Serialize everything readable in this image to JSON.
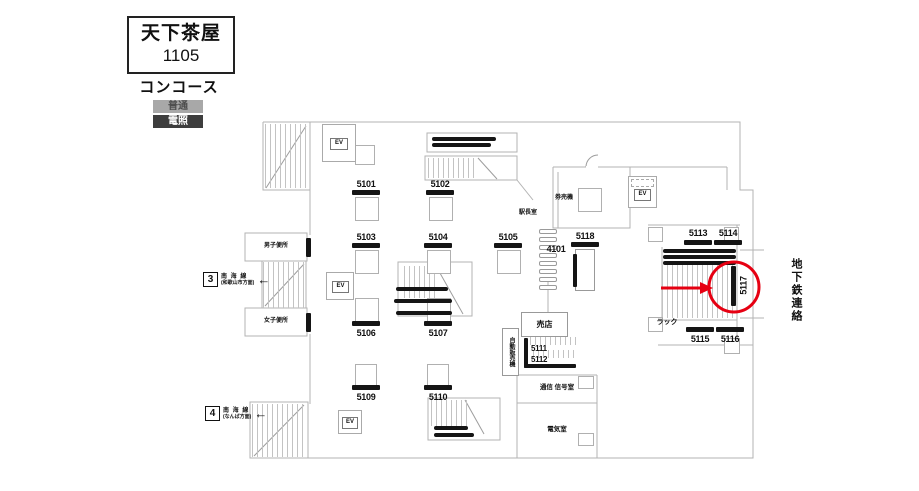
{
  "header": {
    "station": "天下茶屋",
    "code": "1105",
    "area": "コンコース"
  },
  "legend": {
    "normal": "普通",
    "illuminated": "電照"
  },
  "positions": {
    "5101": "5101",
    "5102": "5102",
    "5103": "5103",
    "5104": "5104",
    "5105": "5105",
    "5106": "5106",
    "5107": "5107",
    "5109": "5109",
    "5110": "5110",
    "5111": "5111",
    "5112": "5112",
    "5113": "5113",
    "5114": "5114",
    "5115": "5115",
    "5116": "5116",
    "5117": "5117",
    "5118": "5118",
    "4101": "4101"
  },
  "rooms": {
    "station_master": "駅長室",
    "ticket_machines": "券売機",
    "kiosk": "売店",
    "vending_machines": "自動販売機",
    "comm_signal_room": "通信 信号室",
    "electrical_room": "電気室",
    "rack": "ラック",
    "mens_restroom": "男子便所",
    "womens_restroom": "女子便所",
    "subway_connection": "地下鉄連絡",
    "elevator": "EV"
  },
  "tracks": {
    "t3": {
      "no": "3",
      "line": "南 海 線",
      "direction": "(和歌山市方面)",
      "arrow": "←"
    },
    "t4": {
      "no": "4",
      "line": "南 海 線",
      "direction": "(なんば方面)",
      "arrow": "←"
    }
  },
  "highlight": {
    "target": "5117",
    "color": "#e60012"
  },
  "colors": {
    "wall": "#b3b3b3",
    "ink": "#151515",
    "legend_normal_bg": "#a8a8a8",
    "legend_normal_fg": "#4d4d4d",
    "legend_illuminated_bg": "#3d3d3d",
    "legend_illuminated_fg": "#ffffff"
  }
}
